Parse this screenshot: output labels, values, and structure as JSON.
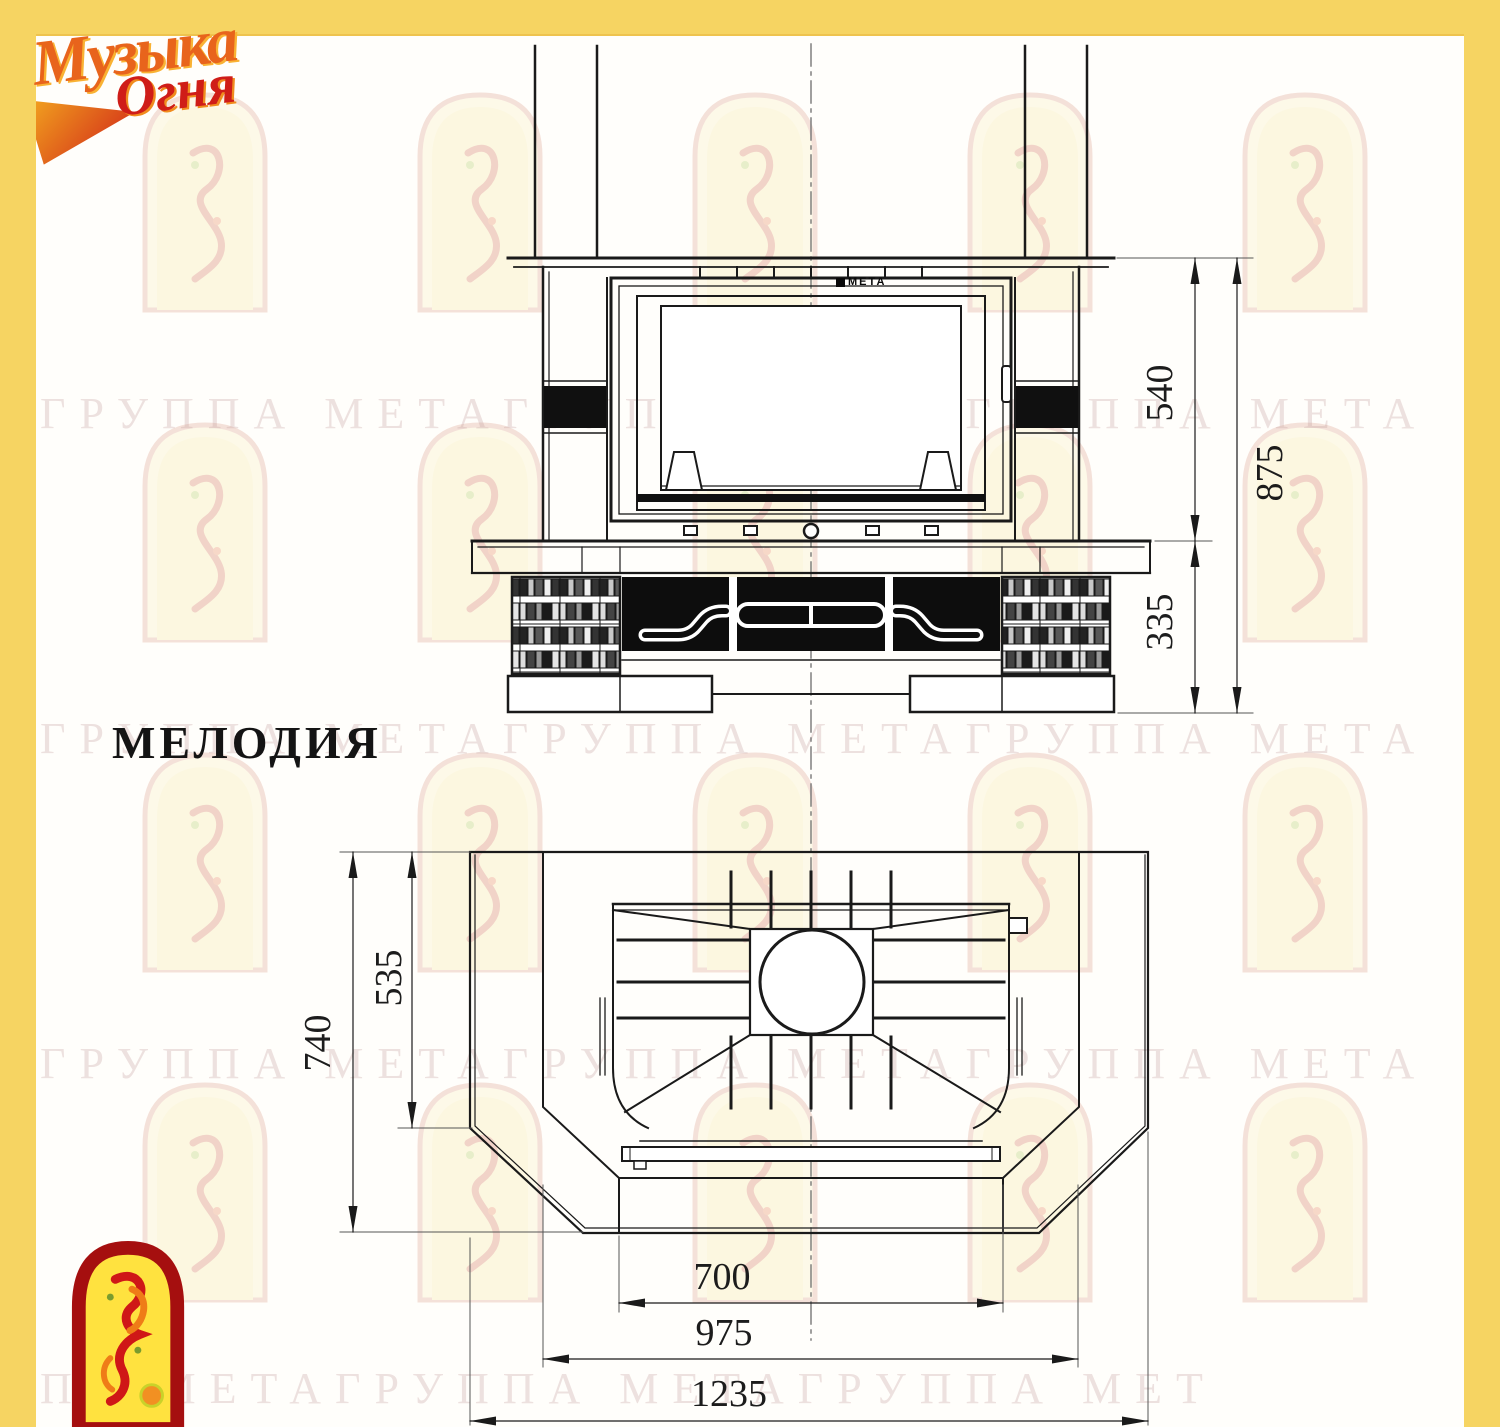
{
  "page": {
    "model_name": "МЕЛОДИЯ"
  },
  "branding": {
    "logo_top": {
      "word1": "Музыка",
      "word2": "Огня"
    },
    "firebox_logo": "МЕТА"
  },
  "watermark": {
    "row1": "ГРУППА МЕТАГРУППА МЕТАГРУППА МЕТА",
    "row2": "ГРУППА МЕТАГРУППА МЕТАГРУППА МЕТА",
    "row3": "ГРУППА МЕТАГРУППА МЕТАГРУППА МЕТА",
    "row4": "ПА МЕТАГРУППА МЕТАГРУППА МЕТ"
  },
  "front_view": {
    "dimensions": {
      "firebox_height_mm": "540",
      "total_height_mm": "875",
      "base_height_mm": "335"
    }
  },
  "plan_view": {
    "dimensions": {
      "total_depth_mm": "740",
      "upper_depth_mm": "535",
      "opening_width_mm": "700",
      "body_width_mm": "975",
      "total_width_mm": "1235"
    }
  },
  "colors": {
    "frame_yellow": "#f6d462",
    "line_black": "#1a1a1a",
    "logo_red": "#cf1d18",
    "logo_orange": "#ef7d1a",
    "logo_arch_yellow": "#ffe23f",
    "logo_arch_border": "#a50f0f"
  }
}
